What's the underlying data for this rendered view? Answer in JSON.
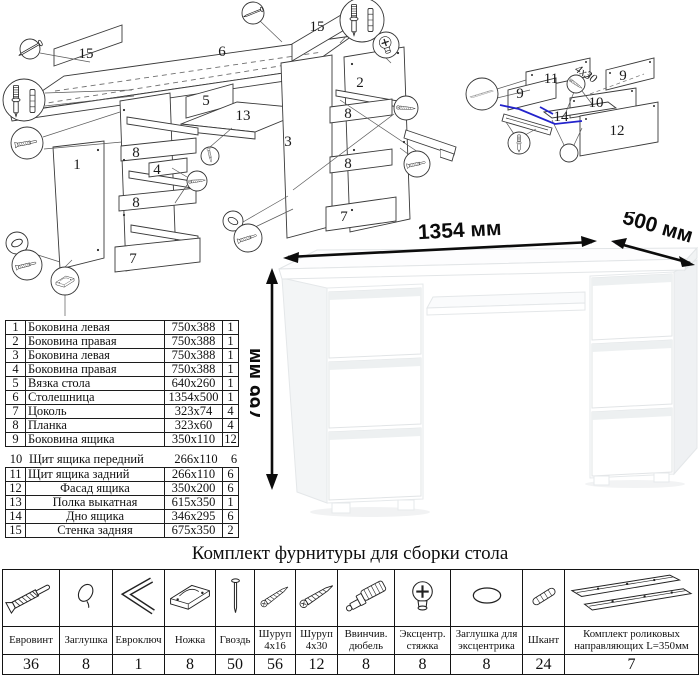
{
  "hardware_title": "Комплект фурнитуры для сборки стола",
  "desk": {
    "width_label": "1354 мм",
    "depth_label": "500 мм",
    "height_label": "766 мм"
  },
  "colors": {
    "accent_blue": "#2323cc",
    "line": "#3a3a3a"
  },
  "parts_table": {
    "rows": [
      {
        "num": "1",
        "name": "Боковина левая",
        "size": "750x388",
        "qty": "1"
      },
      {
        "num": "2",
        "name": "Боковина правая",
        "size": "750x388",
        "qty": "1"
      },
      {
        "num": "3",
        "name": "Боковина левая",
        "size": "750x388",
        "qty": "1"
      },
      {
        "num": "4",
        "name": "Боковина правая",
        "size": "750x388",
        "qty": "1"
      },
      {
        "num": "5",
        "name": "Вязка стола",
        "size": "640x260",
        "qty": "1"
      },
      {
        "num": "6",
        "name": "Столешница",
        "size": "1354x500",
        "qty": "1"
      },
      {
        "num": "7",
        "name": "Цоколь",
        "size": "323x74",
        "qty": "4"
      },
      {
        "num": "8",
        "name": "Планка",
        "size": "323x60",
        "qty": "4"
      },
      {
        "num": "9",
        "name": "Боковина ящика",
        "size": "350x110",
        "qty": "12"
      },
      {
        "num": "10",
        "name": "Щит ящика передний",
        "size": "266x110",
        "qty": "6"
      },
      {
        "num": "11",
        "name": "Щит ящика задний",
        "size": "266x110",
        "qty": "6"
      },
      {
        "num": "12",
        "name": "Фасад ящика",
        "size": "350x200",
        "qty": "6"
      },
      {
        "num": "13",
        "name": "Полка выкатная",
        "size": "615x350",
        "qty": "1"
      },
      {
        "num": "14",
        "name": "Дно ящика",
        "size": "346x295",
        "qty": "6"
      },
      {
        "num": "15",
        "name": "Стенка задняя",
        "size": "675x350",
        "qty": "2"
      }
    ]
  },
  "hardware_table": {
    "items": [
      {
        "icon": "euro-screw-icon",
        "name": "Евровинт",
        "qty": "36"
      },
      {
        "icon": "cap-icon",
        "name": "Заглушка",
        "qty": "8"
      },
      {
        "icon": "hex-key-icon",
        "name": "Евроключ",
        "qty": "1"
      },
      {
        "icon": "foot-icon",
        "name": "Ножка",
        "qty": "8"
      },
      {
        "icon": "nail-icon",
        "name": "Гвоздь",
        "qty": "50"
      },
      {
        "icon": "screw-4x16-icon",
        "name": "Шуруп 4x16",
        "qty": "56"
      },
      {
        "icon": "screw-4x30-icon",
        "name": "Шуруп 4x30",
        "qty": "12"
      },
      {
        "icon": "screw-dowel-icon",
        "name": "Ввинчив. дюбель",
        "qty": "8"
      },
      {
        "icon": "cam-lock-icon",
        "name": "Эксцентр. стяжка",
        "qty": "8"
      },
      {
        "icon": "cam-cap-icon",
        "name": "Заглушка для эксцентрика",
        "qty": "8"
      },
      {
        "icon": "wood-dowel-icon",
        "name": "Шкант",
        "qty": "24"
      },
      {
        "icon": "roller-guides-icon",
        "name": "Комплект роликовых направляющих L=350мм",
        "qty": "7"
      }
    ]
  },
  "exploded_main": {
    "labels": {
      "back_panel_a": "15",
      "desktop": "6",
      "back_panel_b": "15",
      "rail": "5",
      "tray": "13",
      "side_panel_1": "1",
      "panel_2": "2",
      "panel_3": "3",
      "slat_8a": "8",
      "slat_4": "4",
      "slat_8b": "8",
      "plinth_7a": "7",
      "slat_8c": "8",
      "slat_8d": "8",
      "plinth_7b": "7"
    }
  },
  "exploded_drawer": {
    "labels": {
      "back_11": "11",
      "side_9a": "9",
      "side_9b": "9",
      "front_10": "10",
      "bottom_14": "14",
      "facade_12": "12",
      "screw_size": "4x30"
    }
  }
}
